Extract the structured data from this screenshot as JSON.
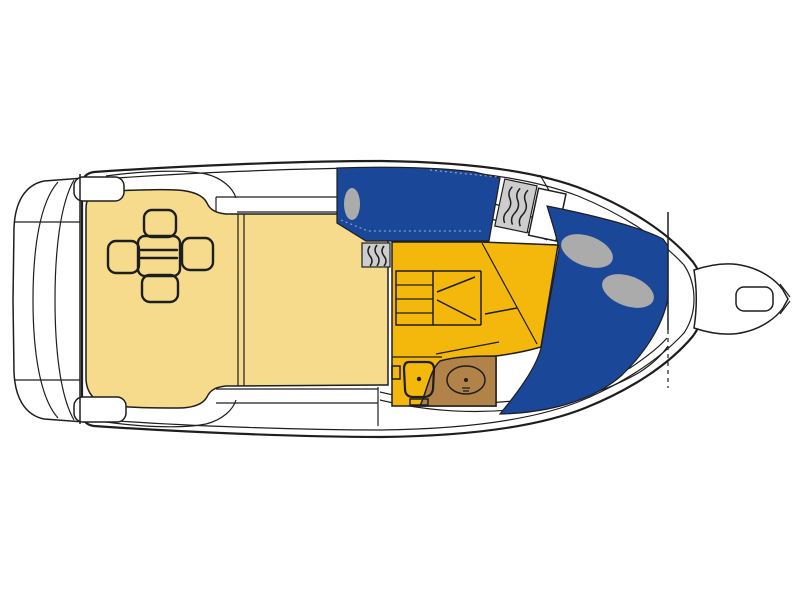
{
  "page": {
    "title": "Motor yacht deck and accommodation plan",
    "type": "boat-floor-plan",
    "view": "top-down"
  },
  "colors": {
    "background": "#FFFFFF",
    "white": "#FFFFFF",
    "line": "#1E1E1E",
    "cream": "#F6DB8D",
    "yellow": "#F4B70C",
    "blue": "#1B4798",
    "brown": "#B18348",
    "pillow_gray": "#ABABAB",
    "panel_gray": "#CDCDCD"
  },
  "regions": [
    {
      "id": "swim-platform",
      "desc": "stern swim platform",
      "color_key": "white"
    },
    {
      "id": "cockpit",
      "desc": "aft cockpit with table and four seats",
      "color_key": "cream"
    },
    {
      "id": "saloon",
      "desc": "saloon floor behind sliding door",
      "color_key": "cream"
    },
    {
      "id": "mid-berth",
      "desc": "mid-cabin double berth with one pillow",
      "color_key": "blue"
    },
    {
      "id": "companionway",
      "desc": "steps down with door swings",
      "color_key": "yellow"
    },
    {
      "id": "galley-passage",
      "desc": "lower-deck passage floor",
      "color_key": "yellow"
    },
    {
      "id": "head",
      "desc": "head compartment: toilet and washbasin vanity",
      "color_key": "brown"
    },
    {
      "id": "v-berth",
      "desc": "forward V-berth with two pillows",
      "color_key": "blue"
    },
    {
      "id": "bow-platform",
      "desc": "bow anchor platform with roller cutout",
      "color_key": "white"
    }
  ]
}
